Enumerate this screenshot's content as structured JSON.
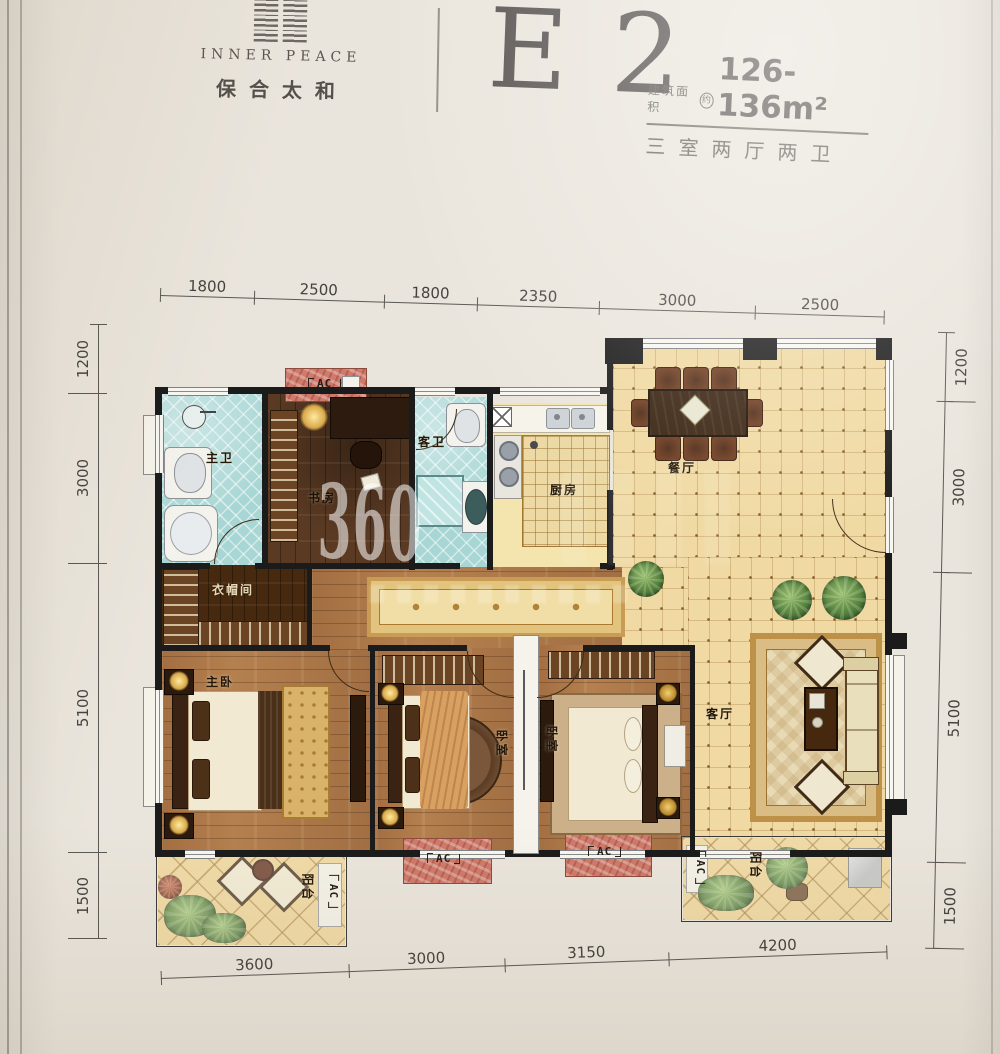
{
  "header": {
    "brand_en": "INNER PEACE",
    "brand_cn": "保合太和",
    "unit_code": "E 2",
    "area_label": "建筑面积",
    "area_approx_mark": "约",
    "area_value": "126-136m²",
    "layout_desc": "三室两厅两卫"
  },
  "watermark": "360",
  "dimensions": {
    "top": [
      "1800",
      "2500",
      "1800",
      "2350",
      "3000",
      "2500"
    ],
    "left": [
      "1200",
      "3000",
      "5100",
      "1500"
    ],
    "right": [
      "1200",
      "3000",
      "5100",
      "1500"
    ],
    "bottom": [
      "3600",
      "3000",
      "3150",
      "4200"
    ]
  },
  "rooms": {
    "master_bath": "主卫",
    "study": "书房",
    "guest_bath": "客卫",
    "kitchen": "厨房",
    "dining": "餐厅",
    "closet": "衣帽间",
    "master_bedroom": "主卧",
    "bedroom2": "卧室",
    "bedroom3": "卧室",
    "living": "客厅",
    "balcony_left": "阳台",
    "balcony_right": "阳台"
  },
  "equipment": {
    "ac_top": "AC",
    "ac_balcony_left": "AC",
    "ac_pad_a": "AC",
    "ac_pad_b": "AC",
    "ac_balcony_right": "AC"
  },
  "colors": {
    "paper": "#eae5dc",
    "wall": "#1b1b1b",
    "tile_warm": "#f0d9a2",
    "tile_teal": "#a7d6d4",
    "wood_dark": "#5a3a23",
    "wood_mid": "#b5804f",
    "ac_pad_red": "#cf7a6a",
    "title_text": "#56514f"
  }
}
